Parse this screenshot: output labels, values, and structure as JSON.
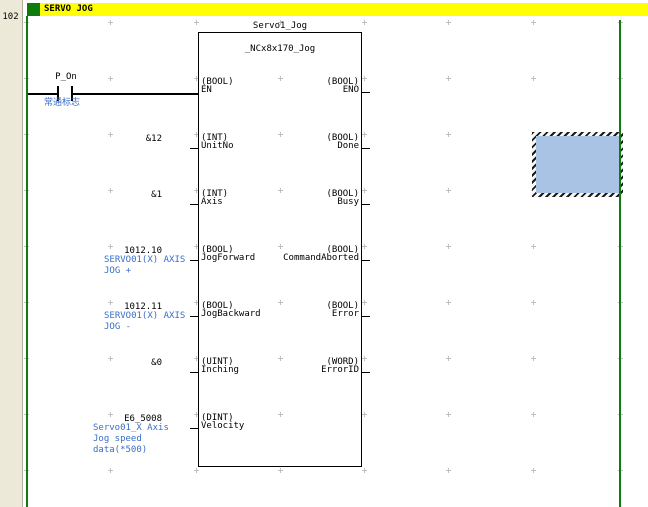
{
  "page": {
    "rung_number": "102",
    "rung_comment": "SERVO JOG"
  },
  "contact": {
    "label": "P_On",
    "comment": "常通标志"
  },
  "function_block": {
    "instance_name": "Servo1_Jog",
    "fb_type": "_NCx8x170_Jog",
    "inputs": [
      {
        "type": "(BOOL)",
        "name": "EN",
        "operand": "",
        "comment_lines": []
      },
      {
        "type": "(INT)",
        "name": "UnitNo",
        "operand": "&12",
        "comment_lines": []
      },
      {
        "type": "(INT)",
        "name": "Axis",
        "operand": "&1",
        "comment_lines": []
      },
      {
        "type": "(BOOL)",
        "name": "JogForward",
        "operand": "1012.10",
        "comment_lines": [
          "SERVO01(X) AXIS",
          "JOG +"
        ]
      },
      {
        "type": "(BOOL)",
        "name": "JogBackward",
        "operand": "1012.11",
        "comment_lines": [
          "SERVO01(X) AXIS",
          "JOG -"
        ]
      },
      {
        "type": "(UINT)",
        "name": "Inching",
        "operand": "&0",
        "comment_lines": []
      },
      {
        "type": "(DINT)",
        "name": "Velocity",
        "operand": "E6_5008",
        "comment_lines": [
          "Servo01_X Axis",
          "Jog speed",
          "data(*500)"
        ]
      }
    ],
    "outputs": [
      {
        "type": "(BOOL)",
        "name": "ENO"
      },
      {
        "type": "(BOOL)",
        "name": "Done"
      },
      {
        "type": "(BOOL)",
        "name": "Busy"
      },
      {
        "type": "(BOOL)",
        "name": "CommandAborted"
      },
      {
        "type": "(BOOL)",
        "name": "Error"
      },
      {
        "type": "(WORD)",
        "name": "ErrorID"
      }
    ]
  },
  "colors": {
    "bus_bar_green": "#0d7c0d",
    "comment_blue": "#3a6ec8",
    "rung_comment_bar_yellow": "#ffff00",
    "margin_beige": "#ece9d8",
    "grid_cross_gray": "#c0c0c0",
    "selection_fill_blue": "#a9c3e5"
  }
}
